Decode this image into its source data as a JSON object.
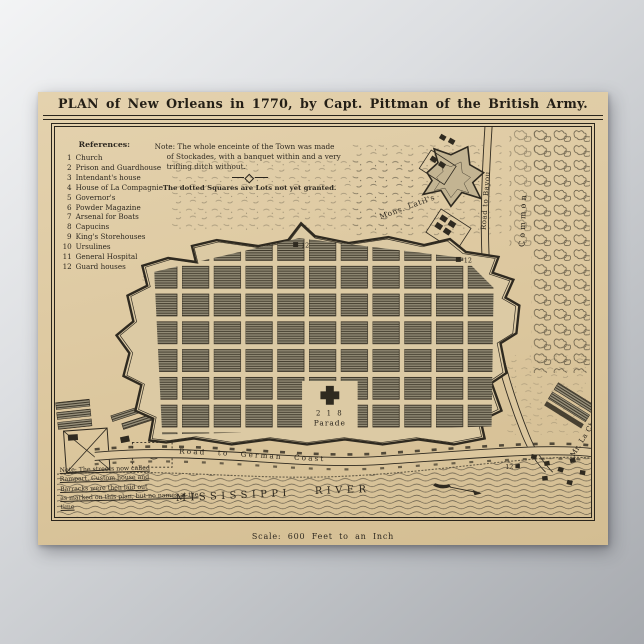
{
  "poster": {
    "title": "PLAN of New Orleans in 1770, by Capt. Pittman of the British Army.",
    "scale_note": "Scale: 600 Feet to an Inch"
  },
  "references": {
    "heading": "References:",
    "items": [
      {
        "num": "1",
        "label": "Church"
      },
      {
        "num": "2",
        "label": "Prison and Guardhouse"
      },
      {
        "num": "3",
        "label": "Intendant's house"
      },
      {
        "num": "4",
        "label": "House of La Compagnie"
      },
      {
        "num": "5",
        "label": "Governor's"
      },
      {
        "num": "6",
        "label": "Powder Magazine"
      },
      {
        "num": "7",
        "label": "Arsenal for Boats"
      },
      {
        "num": "8",
        "label": "Capucins"
      },
      {
        "num": "9",
        "label": "King's Storehouses"
      },
      {
        "num": "10",
        "label": "Ursulines"
      },
      {
        "num": "11",
        "label": "General Hospital"
      },
      {
        "num": "12",
        "label": "Guard houses"
      }
    ]
  },
  "enceinte_note": {
    "line1": "Note: The whole enceinte of the Town was made",
    "line2": "of Stockades, with a banquet within and a very",
    "line3": "trifling ditch without.",
    "dotted": "The dotted Squares are Lots not yet granted."
  },
  "streets_note": {
    "line1": "Note: The streets now called",
    "line2": "Rampart, Custom house and",
    "line3": "Barracks were then laid out",
    "line4": "as marked on this plan, but no names at the time"
  },
  "labels": {
    "parade": "Parade",
    "parade_numbers": "2 1 8",
    "mons_latils": "Mons. Latil's",
    "road_to_bayou": "Road to Bayou",
    "common": "Common",
    "german_coast": "Road to German Coast",
    "mississippi": "MISSISSIPPI",
    "river": "RIVER",
    "la_chaise": "Mr. La Chaise",
    "marker12": "12"
  },
  "colors": {
    "paper": "#dcc79e",
    "ink": "#2a251c",
    "block_fill": "#8f8874",
    "background_gray": "#a7aaaf"
  }
}
